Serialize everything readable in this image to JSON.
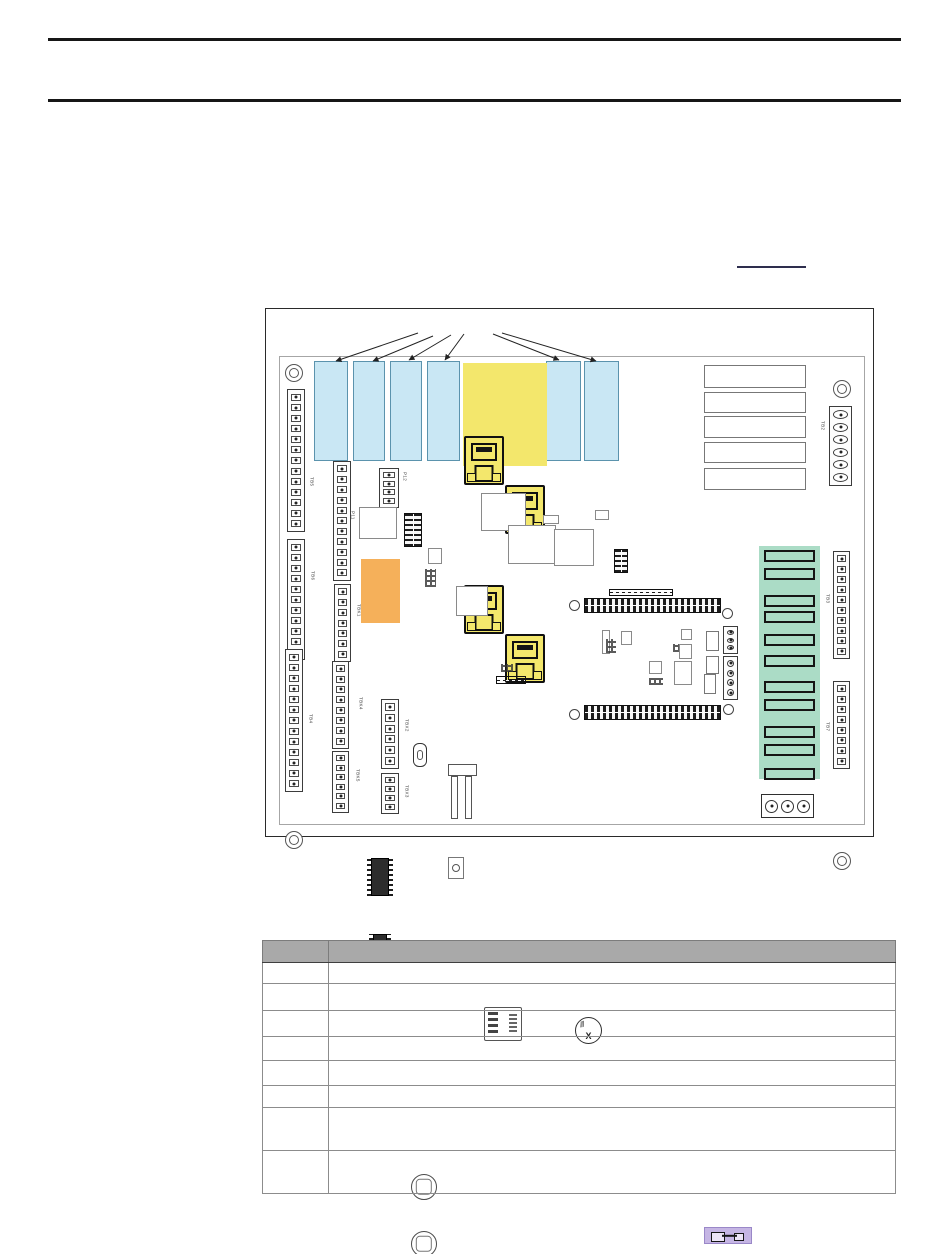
{
  "figure": {
    "board_labels": {
      "tb5": "TB5",
      "tb6": "TB6",
      "tb4": "TB4",
      "tbk1": "TBK1",
      "tbk4": "TBK4",
      "tbk5": "TBK5",
      "tbx2": "TBX2",
      "tbx3": "TBX3",
      "p11": "P11",
      "p12": "P12",
      "tb2": "TB2",
      "tb3": "TB3",
      "tb7": "TB7"
    },
    "battery_mark": "X",
    "highlight_colors": {
      "slot_blue": "#c9e7f4",
      "rj45_yellow": "#f3e76c",
      "dip_orange": "#f5b05a",
      "relay_green": "#abdcc6",
      "fuse_purple": "#c5b5e4"
    }
  },
  "table": {
    "header_cells": [
      "",
      ""
    ],
    "rows": [
      [
        "",
        ""
      ],
      [
        "",
        ""
      ],
      [
        "",
        ""
      ],
      [
        "",
        ""
      ],
      [
        "",
        ""
      ],
      [
        "",
        ""
      ],
      [
        "",
        ""
      ],
      [
        "",
        ""
      ]
    ]
  }
}
